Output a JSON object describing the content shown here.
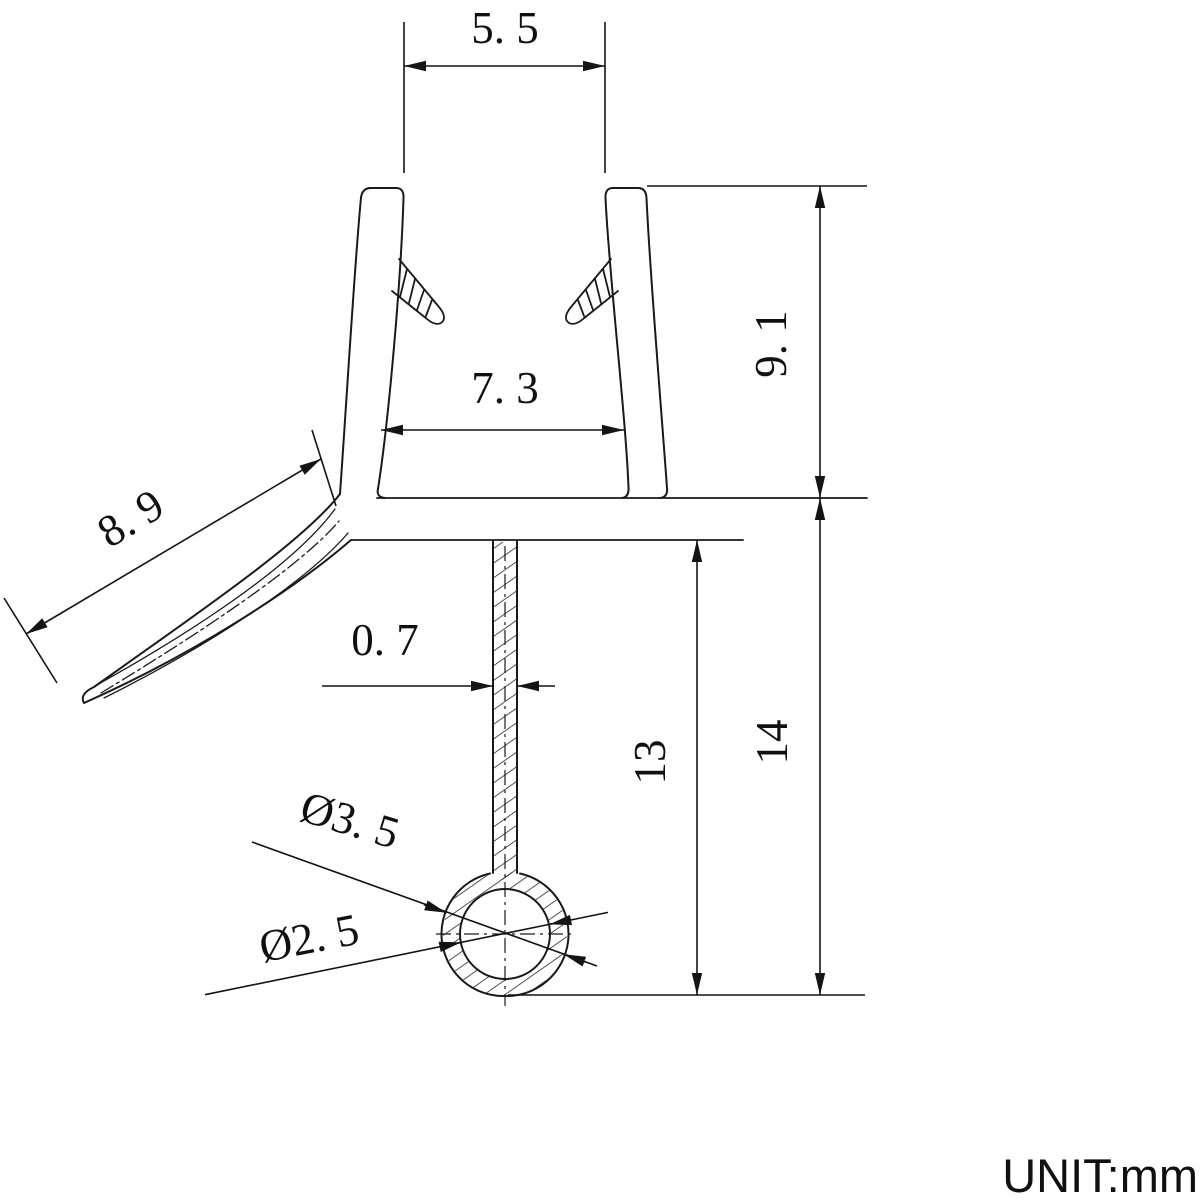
{
  "drawing": {
    "unit_label": "UNIT:mm",
    "dimensions": {
      "top_opening": {
        "value": "5.5",
        "display": "5. 5"
      },
      "inner_width": {
        "value": "7.3",
        "display": "7. 3"
      },
      "channel_height": {
        "value": "9.1",
        "display": "9. 1"
      },
      "flap_length": {
        "value": "8.9",
        "display": "8. 9"
      },
      "stem_width": {
        "value": "0.7",
        "display": "0. 7"
      },
      "stem_height": {
        "value": "13",
        "display": "13"
      },
      "total_height": {
        "value": "14",
        "display": "14"
      },
      "bulb_outer_dia": {
        "value": "3.5",
        "display": "Ø3. 5"
      },
      "bulb_inner_dia": {
        "value": "2.5",
        "display": "Ø2. 5"
      }
    }
  }
}
